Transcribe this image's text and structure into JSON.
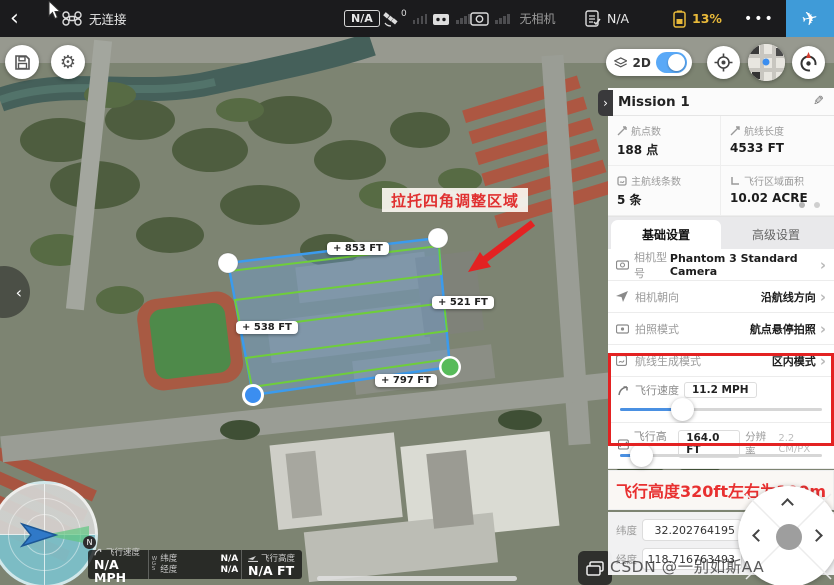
{
  "ui": {
    "back": "‹",
    "fwd": "›",
    "plus": "+",
    "dots": "•••",
    "pencil": "✎",
    "plane": "✈"
  },
  "topbar": {
    "connection_status": "无连接",
    "na_badge": "N/A",
    "satellite_count": "0",
    "camera_status": "无相机",
    "checklist_value": "N/A",
    "battery_percent": "13%",
    "battery_color": "#e8b93a",
    "accent_blue": "#3f9bd8"
  },
  "map": {
    "mode_label": "2D",
    "annotation_label": "拉托四角调整区域",
    "edge_labels": [
      {
        "text": "853 FT"
      },
      {
        "text": "521 FT"
      },
      {
        "text": "538 FT"
      },
      {
        "text": "797 FT"
      }
    ],
    "start_marker": "S",
    "north_label": "N",
    "polygon_color": "#3b9bed",
    "scanline_color": "#6fce3a"
  },
  "panel": {
    "title": "Mission 1",
    "stats": [
      {
        "label": "航点数",
        "value": "188 点"
      },
      {
        "label": "航线长度",
        "value": "4533 FT"
      },
      {
        "label": "主航线条数",
        "value": "5 条"
      },
      {
        "label": "飞行区域面积",
        "value": "10.02 ACRE"
      }
    ],
    "tabs": [
      {
        "label": "基础设置"
      },
      {
        "label": "高级设置"
      }
    ],
    "settings": [
      {
        "label": "相机型号",
        "value": "Phantom 3 Standard Camera"
      },
      {
        "label": "相机朝向",
        "value": "沿航线方向"
      },
      {
        "label": "拍照模式",
        "value": "航点悬停拍照"
      },
      {
        "label": "航线生成模式",
        "value": "区内模式"
      }
    ],
    "sliders": [
      {
        "label": "飞行速度",
        "value": "11.2 MPH",
        "percent": 31
      },
      {
        "label": "飞行高度",
        "value": "164.0 FT",
        "extra_label": "分辨率",
        "extra_value": "2.2 CM/PX",
        "percent": 11
      }
    ],
    "note": "飞行高度320ft左右为100m",
    "coords": [
      {
        "label": "纬度",
        "value": "32.202764195"
      },
      {
        "label": "经度",
        "value": "118.716763493"
      }
    ]
  },
  "statusbar": {
    "speed_label": "飞行速度",
    "speed_value": "N/A MPH",
    "wgs": "W G S",
    "lat_label": "纬度",
    "lat_value": "N/A",
    "lng_label": "经度",
    "lng_value": "N/A",
    "alt_label": "飞行高度",
    "alt_value": "N/A FT"
  },
  "watermark": "CSDN @一别如斯AA"
}
